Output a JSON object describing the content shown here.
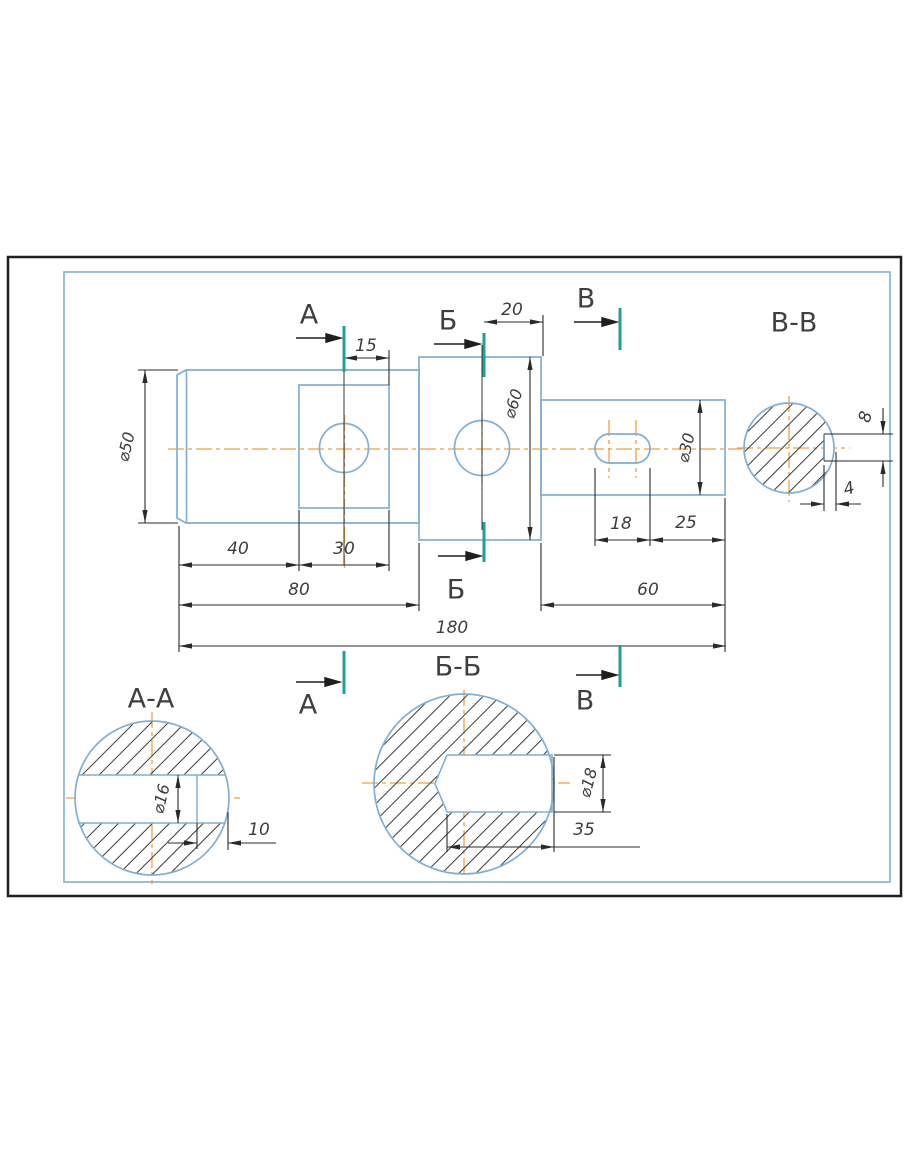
{
  "drawing": {
    "type": "shaft technical drawing with sections",
    "colors": {
      "part_outline": "#7fafd6",
      "dimension_lines": "#2a2a2a",
      "centerline": "#efa23d",
      "section_plane": "#1fa094",
      "hatch": "#3a3a3a",
      "outer_border": "#1f1f1f",
      "text": "#3d3d3d"
    },
    "views": {
      "main": {
        "dimensions": {
          "d50": "⌀50",
          "l15": "15",
          "l20": "20",
          "d60": "⌀60",
          "d30": "⌀30",
          "l18": "18",
          "l25": "25",
          "l40": "40",
          "l30": "30",
          "l80": "80",
          "l60": "60",
          "l180": "180"
        },
        "section_markers": {
          "A": "А",
          "B": "Б",
          "V": "В"
        }
      },
      "section_a": {
        "title": "А-А",
        "dimensions": {
          "d16": "⌀16",
          "l10": "10"
        }
      },
      "section_b": {
        "title": "Б-Б",
        "dimensions": {
          "d18": "⌀18",
          "l35": "35"
        }
      },
      "section_v": {
        "title": "В-В",
        "dimensions": {
          "w8": "8",
          "w4": "4"
        }
      }
    }
  }
}
